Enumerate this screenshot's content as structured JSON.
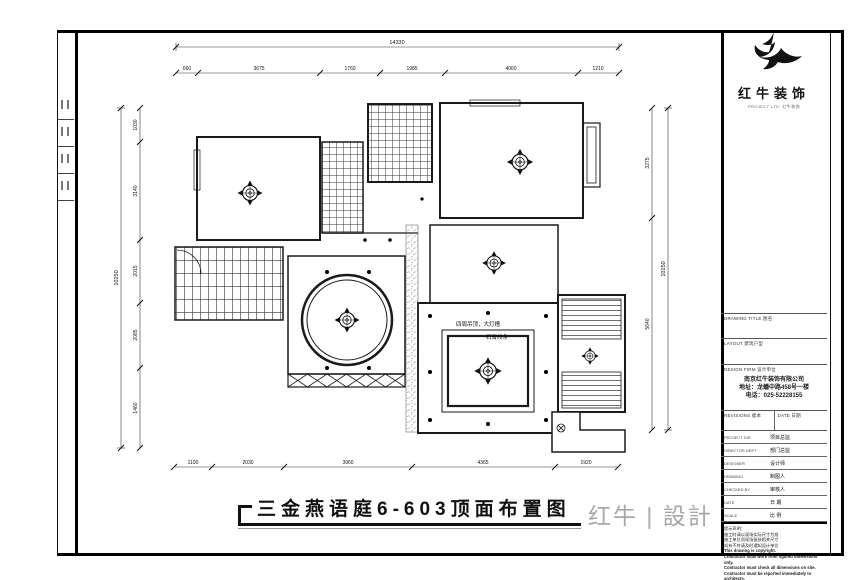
{
  "brand": {
    "name": "红牛装饰",
    "sub": "PROJECT LTD. 红牛装饰",
    "logo_icon": "bull-swoosh"
  },
  "title_block": {
    "drawing_title_label": "DRAWING TITLE 图名",
    "layout_label": "LAYOUT 建筑户型",
    "design_firm_label": "DESIGN FIRM 设计单位",
    "company_name": "南京红牛装饰有限公司",
    "company_address": "地址：龙蟠中路458号一楼",
    "company_phone": "电话：025-52228155",
    "revisions_label": "REVISIONS 版本",
    "date_col_label": "DATE 日期",
    "rows": [
      {
        "en": "PROJECT DIR",
        "zh": "项目总监"
      },
      {
        "en": "DIRECTOR DEPT",
        "zh": "部门总监"
      },
      {
        "en": "DESIGNER",
        "zh": "设计师"
      },
      {
        "en": "DRAWING",
        "zh": "制图人"
      },
      {
        "en": "CHECKED BY",
        "zh": "审核人"
      },
      {
        "en": "DATE",
        "zh": "日 期"
      },
      {
        "en": "SCALE",
        "zh": "比 例"
      }
    ],
    "notes_title": "提示声明：",
    "notes": [
      "施工时请以现场实际尺寸为准",
      "施工单位须现场复核相关尺寸",
      "如有不符请及时通知设计单位",
      "This drawing is copyright.",
      "Contractor shall work from figured dimensions only.",
      "Contractor must check all dimensions on site.",
      "Contractor must be reported immediately to architects."
    ],
    "drawing_no_label": "Drawing NO 图号",
    "job_no_label": "Job NO 合同编号"
  },
  "footer": {
    "title": "三金燕语庭6-603顶面布置图",
    "studio_logo": "红牛 | 設計"
  },
  "plan": {
    "annotations": [
      "四周吊顶，大灯槽",
      "石膏线条"
    ],
    "dimensions": {
      "top_overall": "14330",
      "top": [
        "660",
        "3675",
        "1760",
        "1985",
        "4060",
        "1210"
      ],
      "bottom": [
        "1100",
        "2030",
        "3960",
        "4365",
        "1920"
      ],
      "left_overall": "10250",
      "left": [
        "1030",
        "3140",
        "2015",
        "2085",
        "1460"
      ],
      "right": [
        "3275",
        "5640"
      ],
      "right_overall": "10250"
    }
  }
}
